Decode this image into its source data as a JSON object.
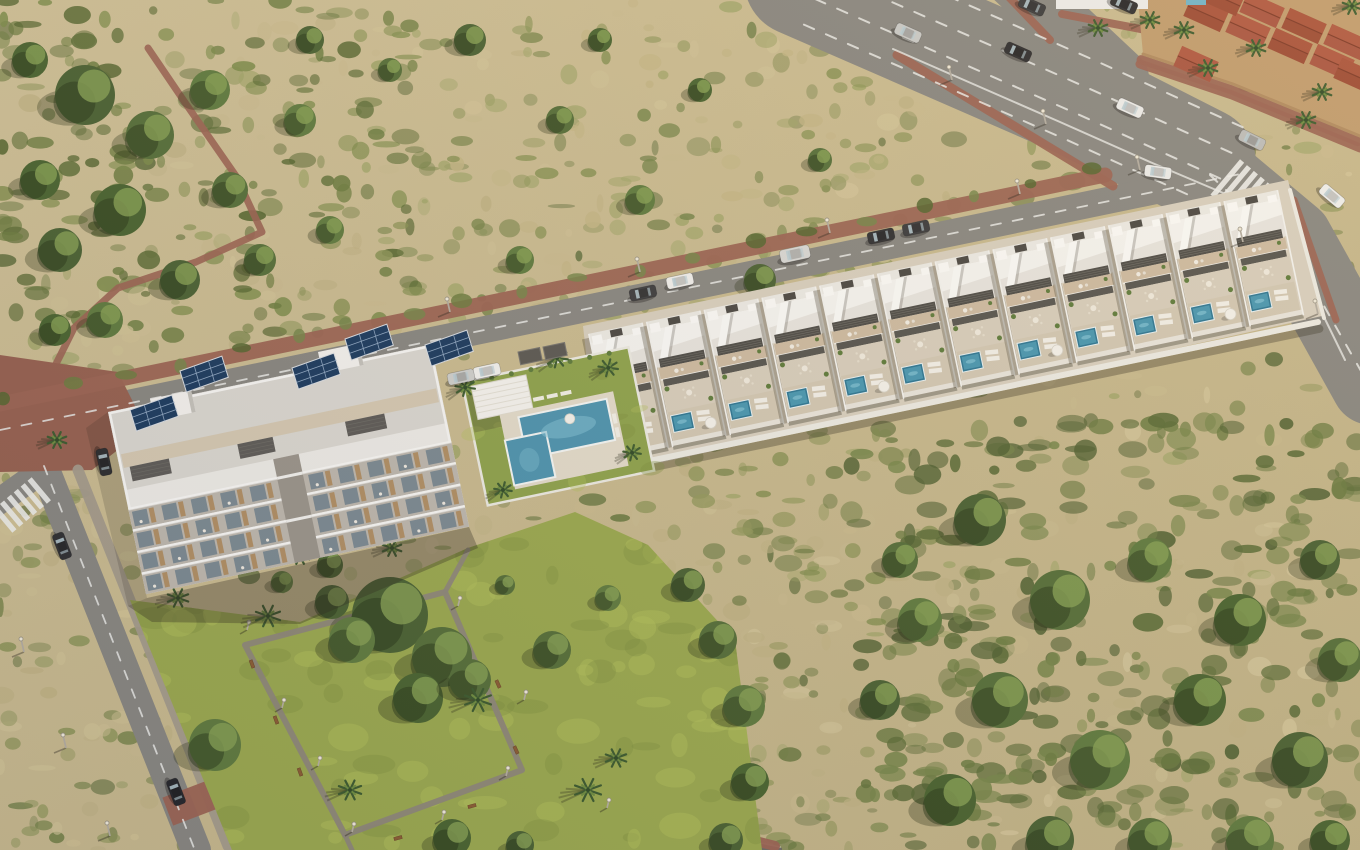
{
  "meta": {
    "description": "Aerial 3D render of a coastal residential development: a four-storey apartment block with rooftop solar panels, a row of twelve white townhouses with private plunge pools along a road, a communal pool garden, a landscaped park with palm trees, a wide avenue with traffic and Mediterranean terracotta-roofed houses in the corner, surrounded by dry scrubland",
    "width": 1360,
    "height": 850
  },
  "palette": {
    "scrub_base_light": "#cfc096",
    "scrub_base_dark": "#c0b184",
    "asphalt": "#888680",
    "asphalt_dark": "#6e6b64",
    "lane_marking": "#e9e9e5",
    "red_sidewalk": "#9b6352",
    "red_plaza": "#96604f",
    "gray_sidewalk": "#a39a8a",
    "park_path": "#8d8678",
    "lawn": "#9aa84e",
    "lawn_light": "#b3c05c",
    "lawn_dark": "#7f8f3e",
    "pool_lawn": "#8ea24b",
    "building_white": "#edebe6",
    "building_roof": "#dad7d0",
    "terrace_beige": "#cdbaa0",
    "louvre_dark": "#4d4b46",
    "pool_water": "#4d93ae",
    "pool_water_small": "#2c7693",
    "pool_highlight": "#7fc0d4",
    "solar_panel": "#1b3a5e",
    "solar_grid": "#8fa7c2",
    "wood_accent": "#b08e63",
    "glass": "#75848e",
    "house_wall_tan": "#c09b6d",
    "roof_terracotta_a": "#9c4a34",
    "roof_terracotta_b": "#a85440",
    "wall_white": "#eceae2",
    "bench_wood": "#8a5c33",
    "palm_frond": "#3c5a2e",
    "tree_greens": [
      "#4a6132",
      "#556e38",
      "#5f7a3e",
      "#49632f"
    ]
  },
  "scrub": {
    "seed": 7,
    "base_blob_count": 720,
    "blob_colors": [
      "#c9ba8e",
      "#d2c498",
      "#bfb183",
      "#8a9355",
      "#79854a",
      "#6b7a42",
      "#5a6a38",
      "#a0a568"
    ],
    "regions": [
      {
        "x": 0,
        "y": 0,
        "w": 420,
        "h": 340,
        "n": 170,
        "colors": [
          "#5f7038",
          "#6d7d40",
          "#55662f",
          "#7d8c4a"
        ],
        "rmin": 4,
        "rmax": 14
      },
      {
        "x": 850,
        "y": 420,
        "w": 510,
        "h": 430,
        "n": 280,
        "colors": [
          "#5a6b36",
          "#4e5f30",
          "#6b7b40",
          "#77864a"
        ],
        "rmin": 5,
        "rmax": 16
      },
      {
        "x": 380,
        "y": 0,
        "w": 500,
        "h": 330,
        "n": 130,
        "colors": [
          "#8a9355",
          "#a0a568",
          "#c3b584",
          "#77854a"
        ],
        "rmin": 4,
        "rmax": 12
      },
      {
        "x": 620,
        "y": 430,
        "w": 260,
        "h": 420,
        "n": 90,
        "colors": [
          "#7d8a4a",
          "#93985c",
          "#c0b283",
          "#65753c"
        ],
        "rmin": 4,
        "rmax": 12
      },
      {
        "x": 0,
        "y": 300,
        "w": 160,
        "h": 550,
        "n": 90,
        "colors": [
          "#8a9355",
          "#c0b283",
          "#6b7b40",
          "#d0c294"
        ],
        "rmin": 4,
        "rmax": 12
      }
    ],
    "tree_clusters": [
      [
        85,
        95,
        30
      ],
      [
        150,
        135,
        24
      ],
      [
        210,
        90,
        20
      ],
      [
        120,
        210,
        26
      ],
      [
        60,
        250,
        22
      ],
      [
        230,
        190,
        18
      ],
      [
        300,
        120,
        16
      ],
      [
        30,
        60,
        18
      ],
      [
        180,
        280,
        20
      ],
      [
        260,
        260,
        16
      ],
      [
        330,
        230,
        14
      ],
      [
        40,
        180,
        20
      ],
      [
        310,
        40,
        14
      ],
      [
        390,
        70,
        12
      ],
      [
        105,
        320,
        18
      ],
      [
        55,
        330,
        16
      ],
      [
        470,
        40,
        16
      ],
      [
        560,
        120,
        14
      ],
      [
        640,
        200,
        15
      ],
      [
        700,
        90,
        12
      ],
      [
        760,
        280,
        16
      ],
      [
        820,
        160,
        12
      ],
      [
        520,
        260,
        14
      ],
      [
        600,
        40,
        12
      ],
      [
        980,
        520,
        26
      ],
      [
        1060,
        600,
        30
      ],
      [
        1150,
        560,
        22
      ],
      [
        1240,
        620,
        26
      ],
      [
        1320,
        560,
        20
      ],
      [
        1000,
        700,
        28
      ],
      [
        1100,
        760,
        30
      ],
      [
        1200,
        700,
        26
      ],
      [
        1300,
        760,
        28
      ],
      [
        1340,
        660,
        22
      ],
      [
        920,
        620,
        22
      ],
      [
        950,
        800,
        26
      ],
      [
        1050,
        840,
        24
      ],
      [
        1150,
        840,
        22
      ],
      [
        1250,
        840,
        24
      ],
      [
        1330,
        840,
        20
      ],
      [
        880,
        700,
        20
      ],
      [
        900,
        560,
        18
      ]
    ]
  },
  "roads": {
    "avenue_main": {
      "centerline": [
        [
          800,
          -20
        ],
        [
          1080,
          102
        ],
        [
          1200,
          163
        ]
      ],
      "width": 112
    },
    "avenue_curve": {
      "centerline": [
        [
          1200,
          163
        ],
        [
          1292,
          240
        ],
        [
          1372,
          384
        ]
      ],
      "width": 82
    },
    "branch_top": {
      "centerline": [
        [
          1120,
          78
        ],
        [
          992,
          -42
        ]
      ],
      "width": 58
    },
    "townhouse_road": {
      "centerline": [
        [
          0,
          430
        ],
        [
          1250,
          171
        ]
      ],
      "width": 27
    },
    "left_road": {
      "centerline": [
        [
          42,
          462
        ],
        [
          196,
          850
        ]
      ],
      "width": 30
    },
    "left_branch": {
      "centerline": [
        [
          46,
          468
        ],
        [
          -6,
          505
        ]
      ],
      "width": 26
    },
    "bottom_stub": [
      [
        695,
        830
      ],
      [
        782,
        848
      ],
      [
        782,
        850
      ],
      [
        698,
        850
      ]
    ],
    "avenue_dash_offsets": [
      -44,
      -16,
      12,
      40
    ],
    "avenue_dash_line": [
      [
        820,
        -12
      ],
      [
        1080,
        102
      ],
      [
        1235,
        172
      ]
    ],
    "curve_dash_line": [
      [
        1210,
        175
      ],
      [
        1295,
        255
      ],
      [
        1365,
        378
      ]
    ],
    "avenue_edge_line": [
      [
        893,
        49
      ],
      [
        1060,
        122
      ],
      [
        1150,
        162
      ],
      [
        1235,
        198
      ],
      [
        1302,
        272
      ],
      [
        1345,
        360
      ]
    ],
    "townhouse_dash_line": [
      [
        0,
        430
      ],
      [
        1245,
        173
      ]
    ],
    "left_dash_line": [
      [
        44,
        466
      ],
      [
        194,
        848
      ]
    ]
  },
  "sidewalks": {
    "red_segments": [
      {
        "pts": [
          [
            897,
            55
          ],
          [
            1113,
            186
          ]
        ],
        "w": 9
      },
      {
        "pts": [
          [
            0,
            404
          ],
          [
            1105,
            175
          ]
        ],
        "w": 15
      },
      {
        "pts": [
          [
            1140,
            64
          ],
          [
            1232,
            95
          ],
          [
            1360,
            148
          ]
        ],
        "w": 9
      },
      {
        "pts": [
          [
            1294,
            200
          ],
          [
            1336,
            320
          ]
        ],
        "w": 7
      },
      {
        "pts": [
          [
            688,
            824
          ],
          [
            775,
            846
          ]
        ],
        "w": 10
      },
      {
        "pts": [
          [
            1006,
            -6
          ],
          [
            1050,
            40
          ]
        ],
        "w": 8
      },
      {
        "pts": [
          [
            1062,
            14
          ],
          [
            1230,
            46
          ]
        ],
        "w": 8
      },
      {
        "pts": [
          [
            148,
            48
          ],
          [
            186,
            104
          ],
          [
            236,
            176
          ],
          [
            262,
            232
          ],
          [
            196,
            262
          ],
          [
            118,
            288
          ],
          [
            74,
            328
          ],
          [
            48,
            380
          ]
        ],
        "w": 7
      }
    ],
    "plaza": [
      [
        0,
        355
      ],
      [
        118,
        372
      ],
      [
        146,
        428
      ],
      [
        92,
        470
      ],
      [
        0,
        472
      ]
    ],
    "gray_segments": [
      {
        "pts": [
          [
            78,
            470
          ],
          [
            228,
            846
          ]
        ],
        "w": 11
      },
      {
        "pts": [
          [
            500,
            568
          ],
          [
            560,
            640
          ],
          [
            622,
            714
          ],
          [
            668,
            782
          ],
          [
            692,
            850
          ]
        ],
        "w": 12
      }
    ],
    "crosswalks": [
      {
        "x": 1248,
        "y": 196,
        "a": 40,
        "n": 7,
        "len": 46
      },
      {
        "x": 22,
        "y": 505,
        "a": -40,
        "n": 6,
        "len": 30
      }
    ],
    "red_band": {
      "x": 193,
      "y": 802,
      "a": 69,
      "w": 30,
      "h": 54
    }
  },
  "park": {
    "lawn": [
      [
        130,
        600
      ],
      [
        300,
        622
      ],
      [
        468,
        548
      ],
      [
        575,
        512
      ],
      [
        648,
        545
      ],
      [
        735,
        640
      ],
      [
        762,
        850
      ],
      [
        232,
        850
      ]
    ],
    "loop": [
      [
        245,
        645
      ],
      [
        445,
        592
      ],
      [
        522,
        770
      ],
      [
        345,
        835
      ]
    ],
    "spurs": [
      [
        [
          445,
          592
        ],
        [
          468,
          550
        ]
      ],
      [
        [
          345,
          835
        ],
        [
          352,
          850
        ]
      ]
    ],
    "benches": [
      [
        252,
        664,
        70
      ],
      [
        276,
        720,
        70
      ],
      [
        300,
        772,
        70
      ],
      [
        398,
        838,
        -15
      ],
      [
        472,
        806,
        -15
      ],
      [
        516,
        750,
        66
      ],
      [
        498,
        684,
        66
      ],
      [
        374,
        596,
        -15
      ]
    ],
    "lamps": [
      [
        247,
        630
      ],
      [
        282,
        708
      ],
      [
        318,
        766
      ],
      [
        352,
        832
      ],
      [
        442,
        820
      ],
      [
        506,
        776
      ],
      [
        524,
        700
      ],
      [
        458,
        606
      ],
      [
        607,
        808
      ]
    ],
    "trees": [
      [
        390,
        615,
        38
      ],
      [
        442,
        657,
        30
      ],
      [
        352,
        640,
        23
      ],
      [
        418,
        698,
        25
      ],
      [
        332,
        602,
        17
      ],
      [
        470,
        680,
        21
      ],
      [
        215,
        745,
        26
      ],
      [
        452,
        838,
        19
      ],
      [
        520,
        845,
        14
      ],
      [
        552,
        650,
        19
      ],
      [
        608,
        598,
        13
      ],
      [
        330,
        565,
        13
      ],
      [
        688,
        585,
        17
      ],
      [
        718,
        640,
        19
      ],
      [
        744,
        706,
        21
      ],
      [
        750,
        782,
        19
      ],
      [
        726,
        840,
        17
      ],
      [
        505,
        585,
        10
      ],
      [
        282,
        582,
        11
      ]
    ],
    "palms": [
      [
        268,
        616,
        13
      ],
      [
        350,
        790,
        12
      ],
      [
        478,
        700,
        14
      ],
      [
        588,
        790,
        14
      ],
      [
        616,
        758,
        11
      ],
      [
        300,
        556,
        10
      ],
      [
        392,
        548,
        10
      ],
      [
        178,
        598,
        11
      ],
      [
        57,
        440,
        10
      ]
    ]
  },
  "pool_area": {
    "origin": [
      462,
      382
    ],
    "angle": -11.8,
    "lawn_w": 170,
    "lawn_h": 126,
    "palms_local": [
      [
        2,
        6,
        10
      ],
      [
        98,
        -4,
        11
      ],
      [
        146,
        16,
        10
      ],
      [
        18,
        114,
        9
      ],
      [
        152,
        104,
        9
      ]
    ],
    "carports": [
      [
        518,
        352
      ],
      [
        543,
        347
      ]
    ]
  },
  "townhouses": {
    "count": 12,
    "origin": [
      588,
      334
    ],
    "step": 59,
    "angle": -11.8,
    "unit_w": 56,
    "unit_d": 128,
    "parasol_every": 3,
    "platform": [
      [
        583,
        326
      ],
      [
        1288,
        180
      ],
      [
        1322,
        316
      ],
      [
        600,
        476
      ]
    ],
    "front_wall": [
      [
        596,
        472
      ],
      [
        1318,
        322
      ]
    ],
    "right_wall": [
      [
        1290,
        190
      ],
      [
        1324,
        318
      ]
    ]
  },
  "apartment": {
    "origin": [
      108,
      412
    ],
    "angle": -11.8,
    "length": 330,
    "depth": 186,
    "shadow": [
      [
        147,
        598
      ],
      [
        469,
        527
      ],
      [
        478,
        548
      ],
      [
        300,
        624
      ],
      [
        152,
        622
      ],
      [
        128,
        606
      ]
    ],
    "side_shadow": [
      [
        108,
        412
      ],
      [
        147,
        598
      ],
      [
        128,
        606
      ],
      [
        86,
        428
      ]
    ],
    "solar_arrays": [
      [
        130,
        410
      ],
      [
        180,
        371
      ],
      [
        292,
        368
      ],
      [
        345,
        339
      ],
      [
        425,
        345
      ]
    ],
    "towers": [
      [
        150,
        399
      ],
      [
        318,
        352
      ]
    ]
  },
  "houses_tr": {
    "block": [
      [
        1138,
        0
      ],
      [
        1360,
        0
      ],
      [
        1360,
        136
      ],
      [
        1233,
        84
      ],
      [
        1143,
        54
      ]
    ],
    "wall": [
      [
        1143,
        54
      ],
      [
        1233,
        84
      ],
      [
        1360,
        136
      ]
    ],
    "roofs": [
      [
        1206,
        14
      ],
      [
        1248,
        30
      ],
      [
        1290,
        46
      ],
      [
        1332,
        62
      ],
      [
        1356,
        76
      ],
      [
        1262,
        10
      ],
      [
        1304,
        26
      ],
      [
        1346,
        42
      ],
      [
        1222,
        -2
      ],
      [
        1196,
        64
      ]
    ],
    "roof_w": 40,
    "roof_h": 22,
    "roof_angle": 24,
    "palms": [
      [
        1150,
        20
      ],
      [
        1184,
        30
      ],
      [
        1256,
        48
      ],
      [
        1322,
        92
      ],
      [
        1208,
        68
      ],
      [
        1306,
        120
      ],
      [
        1352,
        6
      ],
      [
        1098,
        28
      ]
    ],
    "white_band": [
      1056,
      0,
      92,
      9
    ],
    "teal_sliver": [
      1186,
      0,
      20,
      5
    ]
  },
  "street_lamps": {
    "townhouse_road": [
      [
        450,
        312
      ],
      [
        640,
        272
      ],
      [
        830,
        233
      ],
      [
        1020,
        194
      ]
    ],
    "avenue": [
      [
        952,
        80
      ],
      [
        1046,
        124
      ],
      [
        1140,
        170
      ],
      [
        1243,
        242
      ],
      [
        1318,
        314
      ]
    ],
    "left_road": [
      [
        24,
        652
      ],
      [
        66,
        748
      ],
      [
        110,
        836
      ]
    ]
  },
  "cars": [
    {
      "x": 908,
      "y": 33,
      "a": 24,
      "c": "#c9c9c7"
    },
    {
      "x": 1018,
      "y": 52,
      "a": 24,
      "c": "#2c2c2e"
    },
    {
      "x": 1130,
      "y": 108,
      "a": 24,
      "c": "#ececeb"
    },
    {
      "x": 1252,
      "y": 140,
      "a": 26,
      "c": "#bcbcba"
    },
    {
      "x": 1332,
      "y": 196,
      "a": 40,
      "c": "#efefed"
    },
    {
      "x": 1032,
      "y": 6,
      "a": 24,
      "c": "#3a3a3c"
    },
    {
      "x": 1124,
      "y": 4,
      "a": 24,
      "c": "#2e2e30"
    },
    {
      "x": 1158,
      "y": 172,
      "a": 8,
      "c": "#ececea"
    },
    {
      "x": 795,
      "y": 254,
      "a": -12,
      "c": "#d8d8d5",
      "s": 1.12
    },
    {
      "x": 680,
      "y": 281,
      "a": -12,
      "c": "#f0efec"
    },
    {
      "x": 643,
      "y": 293,
      "a": -12,
      "c": "#3c3c3e"
    },
    {
      "x": 881,
      "y": 236,
      "a": -12,
      "c": "#2f2f31"
    },
    {
      "x": 916,
      "y": 228,
      "a": -12,
      "c": "#3a3a3c"
    },
    {
      "x": 104,
      "y": 462,
      "a": 78,
      "c": "#2b2b2d"
    },
    {
      "x": 62,
      "y": 546,
      "a": 69,
      "c": "#2f2f31"
    },
    {
      "x": 176,
      "y": 792,
      "a": 69,
      "c": "#26262a"
    },
    {
      "x": 487,
      "y": 371,
      "a": -12,
      "c": "#f2f1ee"
    },
    {
      "x": 461,
      "y": 377,
      "a": -12,
      "c": "#cfcfcc"
    }
  ]
}
